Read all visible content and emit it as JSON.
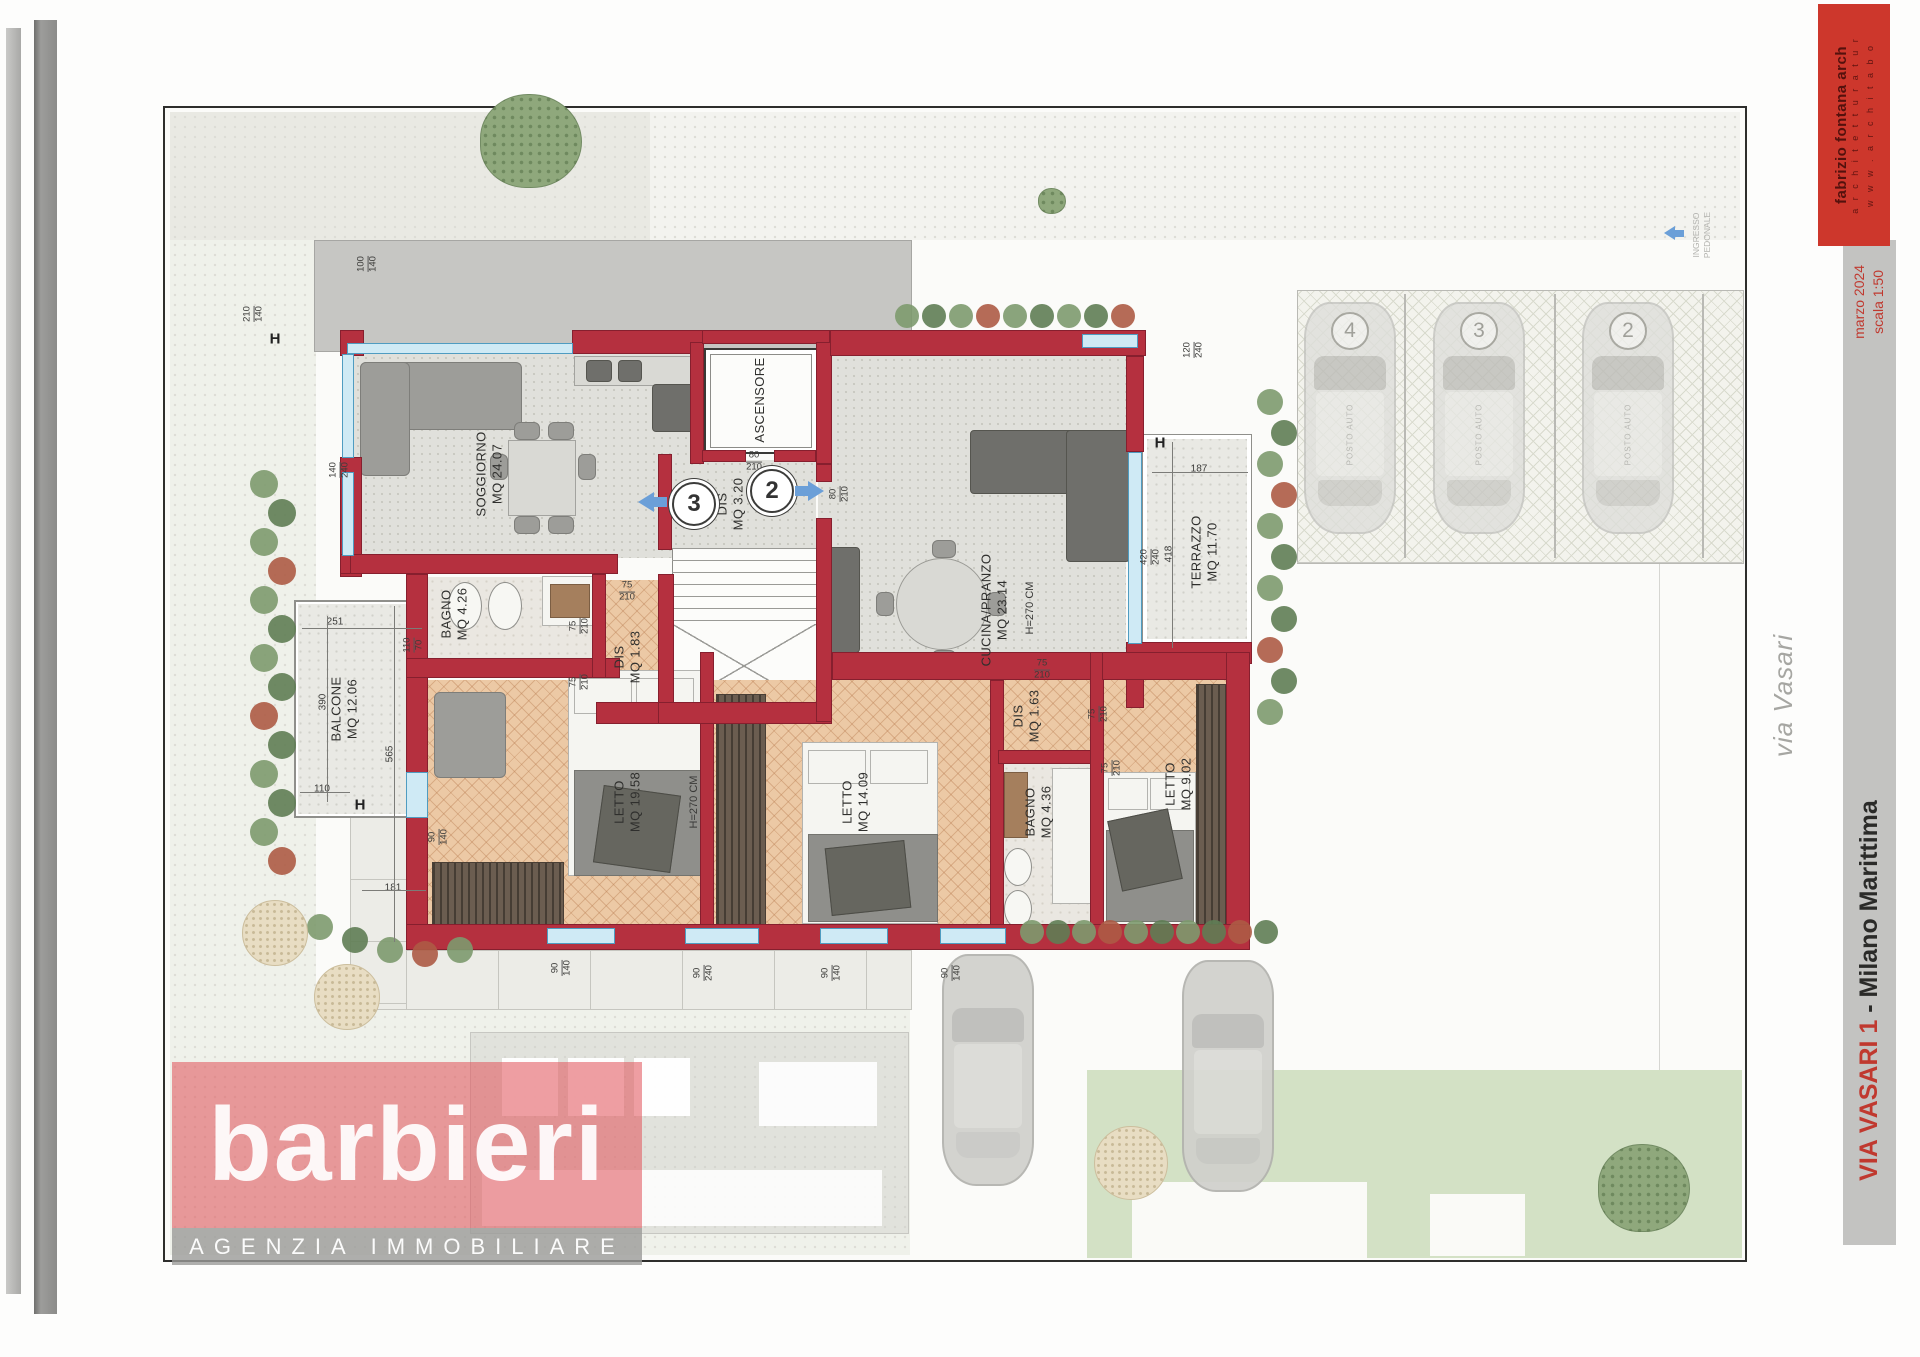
{
  "logo": {
    "name": "barbieri",
    "tagline": "AGENZIA IMMOBILIARE"
  },
  "title_block": {
    "architect": "fabrizio fontana arch",
    "architect_sub": "a r c h i t e t t u r a   t u r",
    "architect_web": "w w w . a r c h i t a b o",
    "date": "marzo 2024",
    "scale": "scala 1:50",
    "project_street": "VIA VASARI 1",
    "project_city": " - Milano Marittima",
    "street_label": "via Vasari",
    "pedestrian_entrance_line1": "INGRESSO",
    "pedestrian_entrance_line2": "PEDONALE"
  },
  "plan": {
    "rooms": [
      {
        "name": "SOGGIORNO",
        "area": "MQ 24.07"
      },
      {
        "name": "CUCINA/PRANZO",
        "area": "MQ 23.14"
      },
      {
        "name": "LETTO",
        "area": "MQ 19.58"
      },
      {
        "name": "LETTO",
        "area": "MQ 14.09"
      },
      {
        "name": "LETTO",
        "area": "MQ 9.02"
      },
      {
        "name": "BAGNO",
        "area": "MQ 4.26"
      },
      {
        "name": "BAGNO",
        "area": "MQ 4.36"
      },
      {
        "name": "DIS",
        "area": "MQ 1.83"
      },
      {
        "name": "DIS",
        "area": "MQ 1.63"
      },
      {
        "name": "DIS",
        "area": "MQ 3.20"
      },
      {
        "name": "ASCENSORE",
        "area": ""
      },
      {
        "name": "BALCONE",
        "area": "MQ 12.06"
      },
      {
        "name": "TERRAZZO",
        "area": "MQ 11.70"
      }
    ],
    "height_note": "H=270 CM",
    "unit_markers": [
      "3",
      "2"
    ],
    "section_marker": "H",
    "dimensions": [
      "100/140",
      "210/140",
      "140/240",
      "251",
      "110/70",
      "390",
      "565",
      "110",
      "181",
      "90/140",
      "90/140",
      "90/240",
      "90/140",
      "90/140",
      "75/210",
      "75/210",
      "75/210",
      "75/210",
      "75/210",
      "75/210",
      "80/210",
      "80/210",
      "120/240",
      "187",
      "418",
      "420/240"
    ],
    "parking": {
      "stall_numbers": [
        "4",
        "3",
        "2"
      ],
      "car_label": "POSTO AUTO"
    }
  },
  "colors": {
    "wall_red": "#b5303f",
    "window_blue": "#4f9cc1",
    "accent_red": "#c0392f",
    "logo_pink": "#e2585f"
  }
}
